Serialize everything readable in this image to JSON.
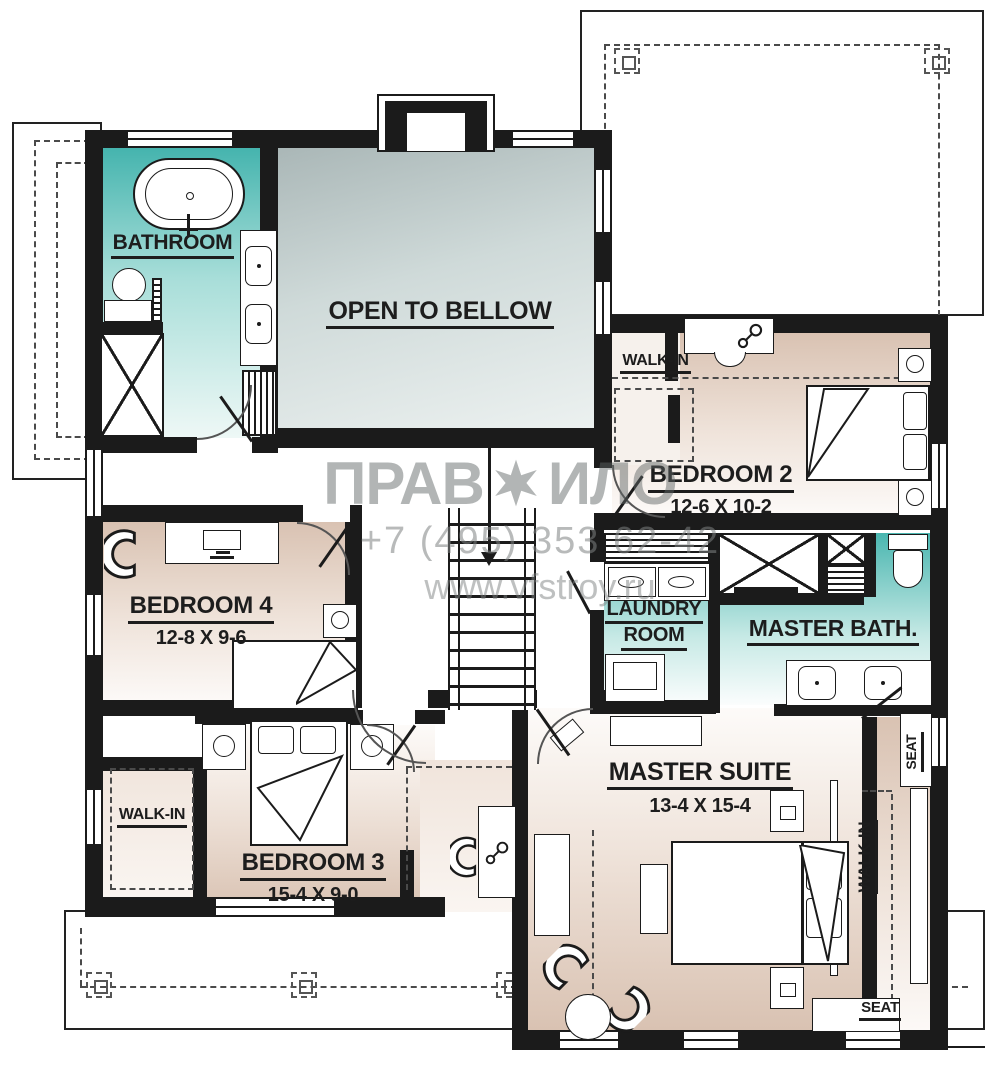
{
  "watermark": {
    "logo_left": "ПРАВ",
    "logo_right": "ИЛО",
    "phone": "+7 (495) 353 62-42",
    "website": "www.vfstroy.ru"
  },
  "rooms": {
    "bathroom": {
      "name": "BATHROOM"
    },
    "open_to_below": {
      "name": "OPEN TO BELLOW"
    },
    "bedroom2": {
      "name": "BEDROOM 2",
      "dims": "12-6 X 10-2"
    },
    "walk_in_bedroom2": {
      "name": "WALK-IN"
    },
    "laundry": {
      "line1": "LAUNDRY",
      "line2": "ROOM"
    },
    "master_bath": {
      "name": "MASTER BATH."
    },
    "bedroom4": {
      "name": "BEDROOM 4",
      "dims": "12-8 X 9-6"
    },
    "walk_in_bedroom3": {
      "name": "WALK-IN"
    },
    "bedroom3": {
      "name": "BEDROOM 3",
      "dims": "15-4 X 9-0"
    },
    "master_suite": {
      "name": "MASTER SUITE",
      "dims": "13-4 X 15-4"
    },
    "walk_in_master": {
      "name": "WALK-IN"
    },
    "seat_upper": {
      "label": "SEAT"
    },
    "seat_lower": {
      "label": "SEAT"
    }
  },
  "colors": {
    "wall": "#1b1b1b",
    "teal": "#45b4ae",
    "beige": "#d9c2b2",
    "open_gray": "#aab7b7"
  }
}
